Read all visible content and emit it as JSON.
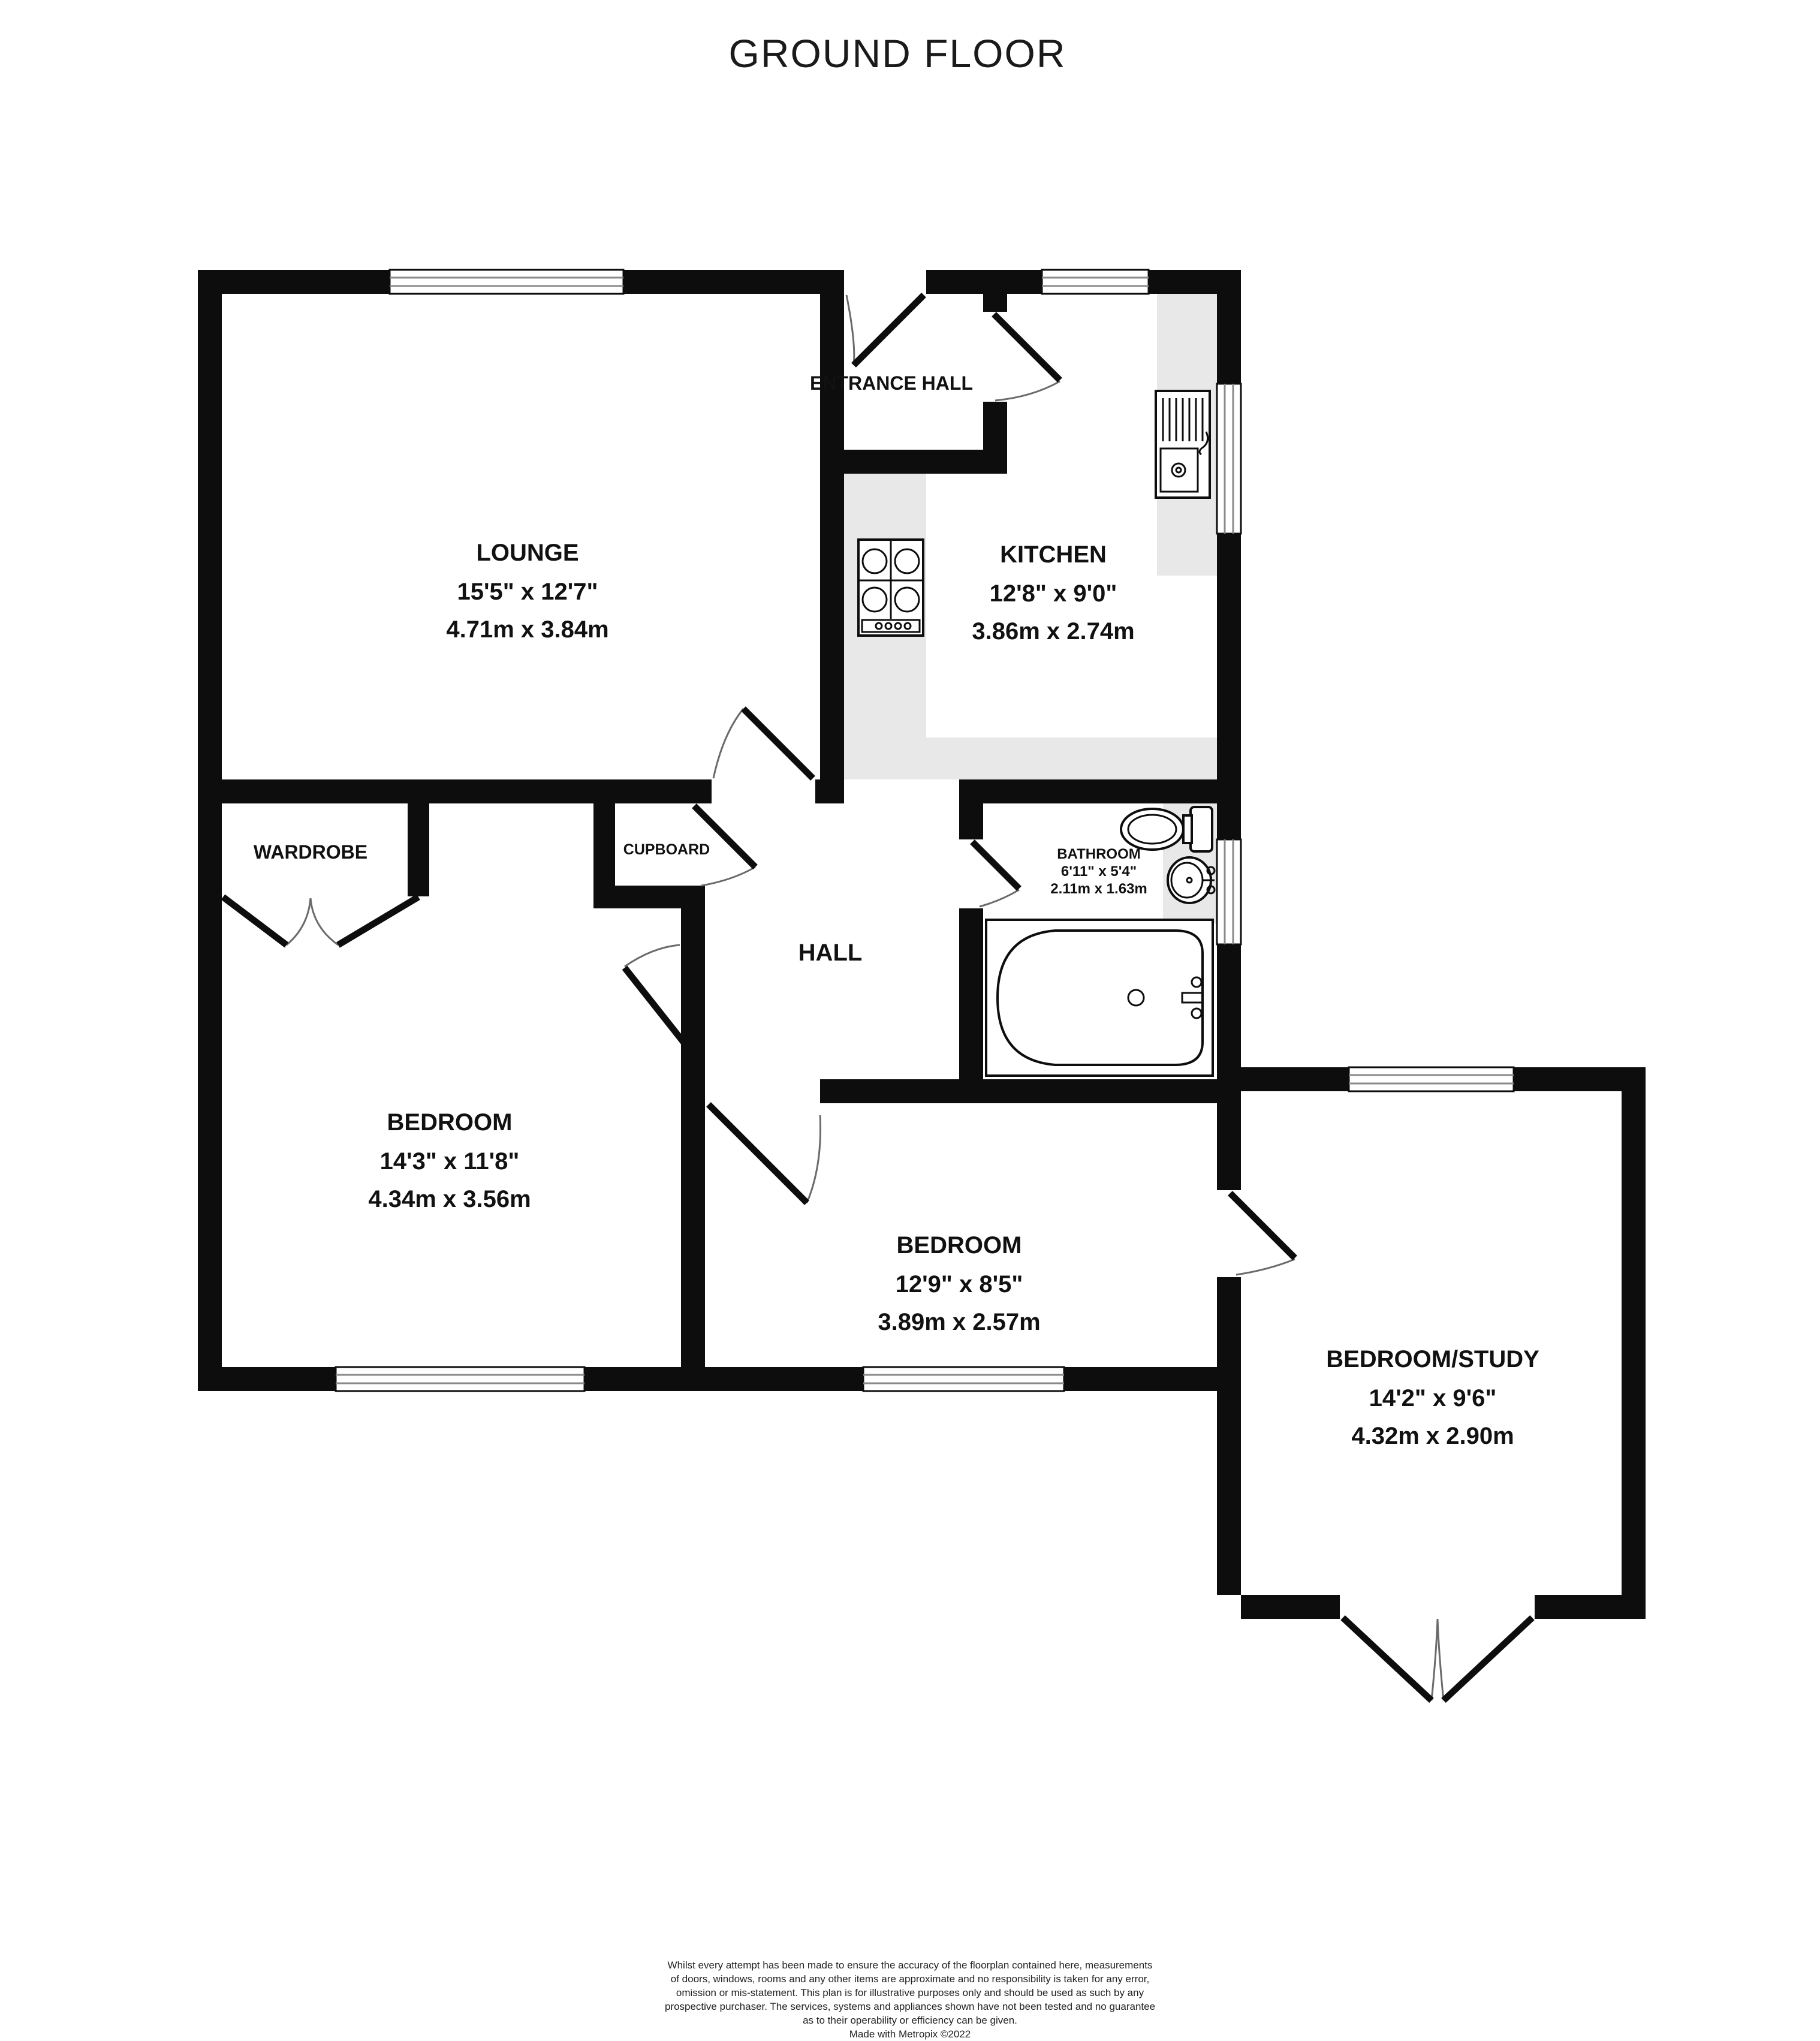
{
  "title": "GROUND FLOOR",
  "rooms": {
    "lounge": {
      "name": "LOUNGE",
      "imperial": "15'5\"  x 12'7\"",
      "metric": "4.71m  x 3.84m"
    },
    "entrance_hall": {
      "name": "ENTRANCE HALL"
    },
    "kitchen": {
      "name": "KITCHEN",
      "imperial": "12'8\"  x 9'0\"",
      "metric": "3.86m  x 2.74m"
    },
    "bathroom": {
      "name": "BATHROOM",
      "imperial": "6'11\"  x 5'4\"",
      "metric": "2.11m  x 1.63m"
    },
    "bedroom1": {
      "name": "BEDROOM",
      "imperial": "14'3\"  x 11'8\"",
      "metric": "4.34m  x 3.56m"
    },
    "bedroom2": {
      "name": "BEDROOM",
      "imperial": "12'9\"  x 8'5\"",
      "metric": "3.89m  x 2.57m"
    },
    "study": {
      "name": "BEDROOM/STUDY",
      "imperial": "14'2\"  x 9'6\"",
      "metric": "4.32m  x 2.90m"
    },
    "hall": {
      "name": "HALL"
    },
    "wardrobe": {
      "name": "WARDROBE"
    },
    "cupboard": {
      "name": "CUPBOARD"
    }
  },
  "disclaimer": {
    "line1": "Whilst every attempt has been made to ensure the accuracy of the floorplan contained here, measurements",
    "line2": "of doors, windows, rooms and any other items are approximate and no responsibility is taken for any error,",
    "line3": "omission or mis-statement. This plan is for illustrative purposes only and should be used as such by any",
    "line4": "prospective purchaser. The services, systems and appliances shown have not been tested and no guarantee",
    "line5": "as to their operability or efficiency can be given.",
    "credit": "Made with Metropix ©2022"
  },
  "colors": {
    "wall": "#0d0d0d",
    "counter": "#e8e8e8",
    "background": "#ffffff"
  }
}
